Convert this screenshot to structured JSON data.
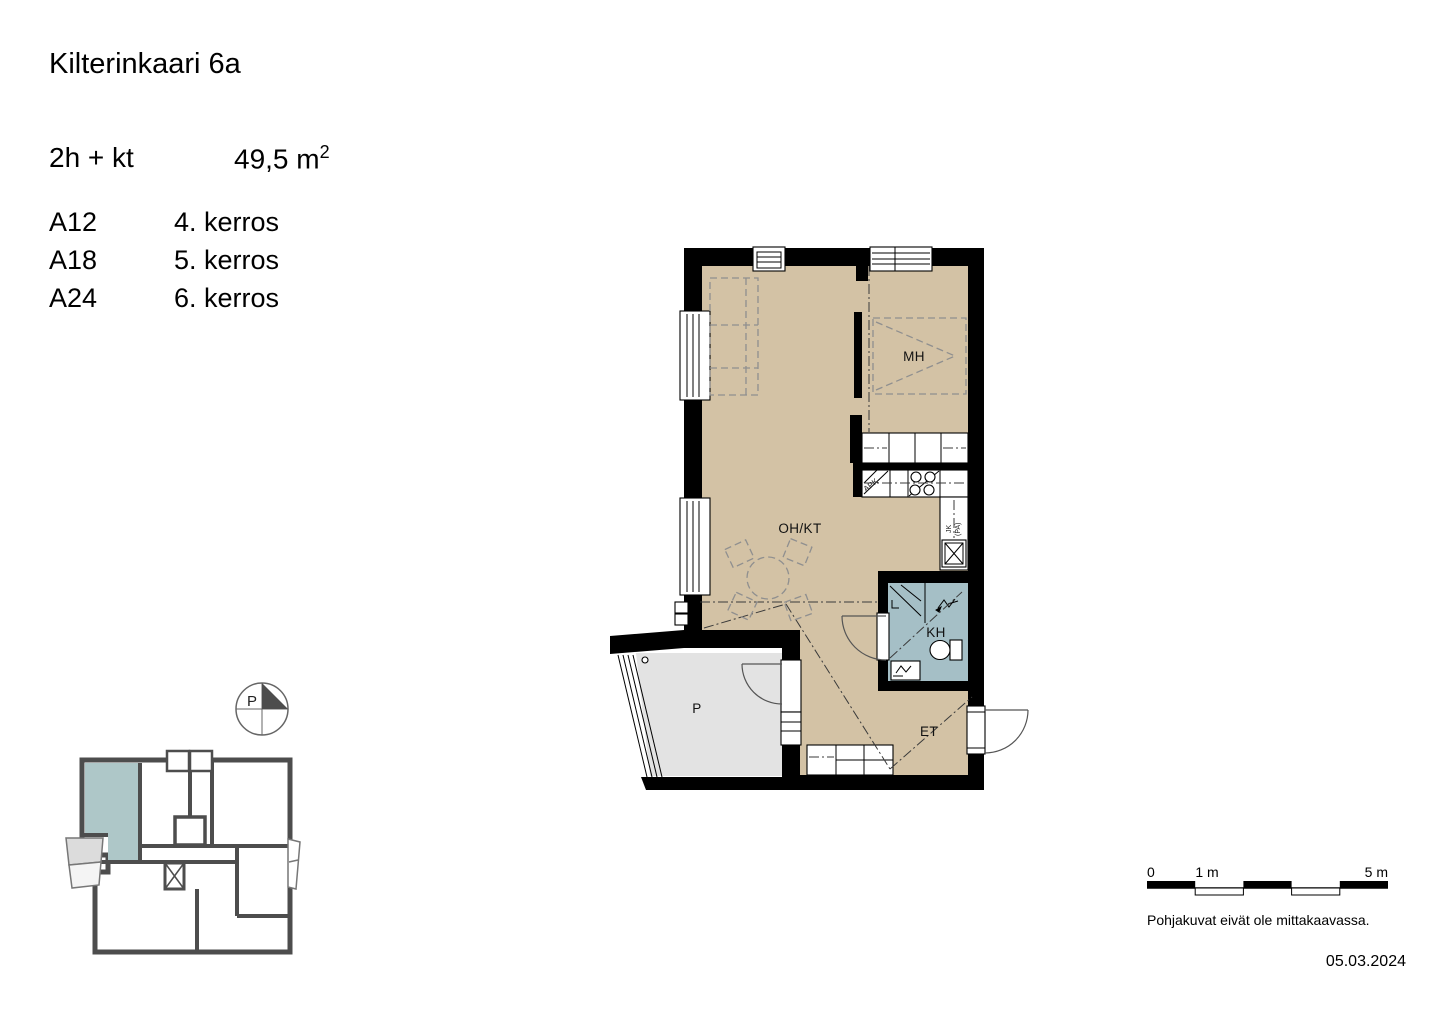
{
  "header": {
    "title": "Kilterinkaari 6a",
    "apartment_type": "2h + kt",
    "area": "49,5 m",
    "area_sup": "2",
    "apartments": [
      {
        "code": "A12",
        "floor": "4. kerros"
      },
      {
        "code": "A18",
        "floor": "5. kerros"
      },
      {
        "code": "A24",
        "floor": "6. kerros"
      }
    ]
  },
  "plan": {
    "labels": {
      "bedroom": "MH",
      "living_kitchen": "OH/KT",
      "bathroom": "KH",
      "hallway": "ET",
      "balcony": "P",
      "dishwasher": "APK",
      "fridge": "JK",
      "freezer": "(PA)"
    },
    "colors": {
      "floor": "#d3c2a5",
      "bathroom_floor": "#a5bfc6",
      "balcony_floor": "#e3e3e3",
      "wall": "#000000",
      "key_plan_wall": "#4d4d4d",
      "key_plan_unit": "#aec7c8"
    }
  },
  "compass": {
    "label": "P"
  },
  "scale_bar": {
    "tick_zero": "0",
    "tick_one": "1 m",
    "tick_five": "5 m"
  },
  "footer": {
    "disclaimer": "Pohjakuvat eivät ole mittakaavassa.",
    "date": "05.03.2024"
  }
}
